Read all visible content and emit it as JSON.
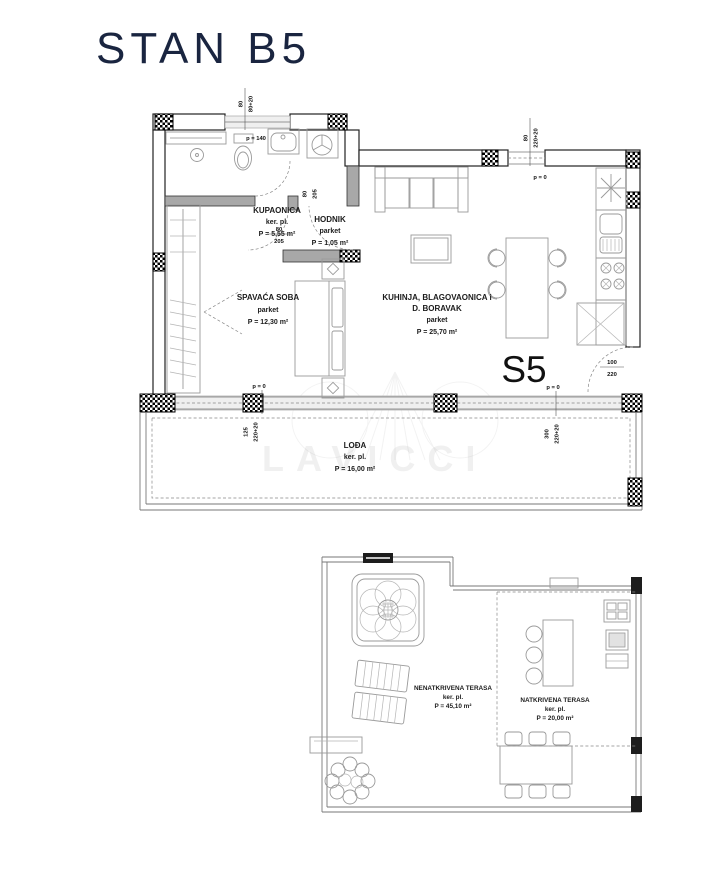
{
  "title": "STAN B5",
  "unit": "S5",
  "watermark": "LAVICCI",
  "rooms": {
    "kupaonica": {
      "name": "KUPAONICA",
      "floor": "ker. pl.",
      "area": "P = 5,55 m²"
    },
    "hodnik": {
      "name": "HODNIK",
      "floor": "parket",
      "area": "P = 1,05 m²"
    },
    "spavaca_soba": {
      "name": "SPAVAĆA SOBA",
      "floor": "parket",
      "area": "P = 12,30 m²"
    },
    "kuhinja": {
      "name_line1": "KUHINJA, BLAGOVAONICA i",
      "name_line2": "D. BORAVAK",
      "floor": "parket",
      "area": "P = 25,70 m²"
    },
    "lodja": {
      "name": "LOĐA",
      "floor": "ker. pl.",
      "area": "P = 16,00 m²"
    },
    "nenatkrivena_terasa": {
      "name": "NENATKRIVENA TERASA",
      "floor": "ker. pl.",
      "area": "P = 45,10 m²"
    },
    "natkrivena_terasa": {
      "name": "NATKRIVENA TERASA",
      "floor": "ker. pl.",
      "area": "P = 20,00 m²"
    }
  },
  "dimensions": {
    "p0": "p = 0",
    "p140": "p = 140",
    "bath_window": {
      "w": "80",
      "h": "80+20"
    },
    "living_top_door": {
      "w": "80",
      "h": "220+20"
    },
    "bath_door": {
      "w": "80",
      "h": "205"
    },
    "bedroom_door": {
      "w": "80",
      "h": "205"
    },
    "bedroom_window": {
      "w": "125",
      "h": "220+20"
    },
    "living_window": {
      "w": "300",
      "h": "220+20"
    },
    "kitchen_door": {
      "w": "100",
      "h": "220"
    }
  },
  "colors": {
    "title": "#1a2540",
    "wall": "#222222",
    "furniture": "#9a9a9a"
  }
}
